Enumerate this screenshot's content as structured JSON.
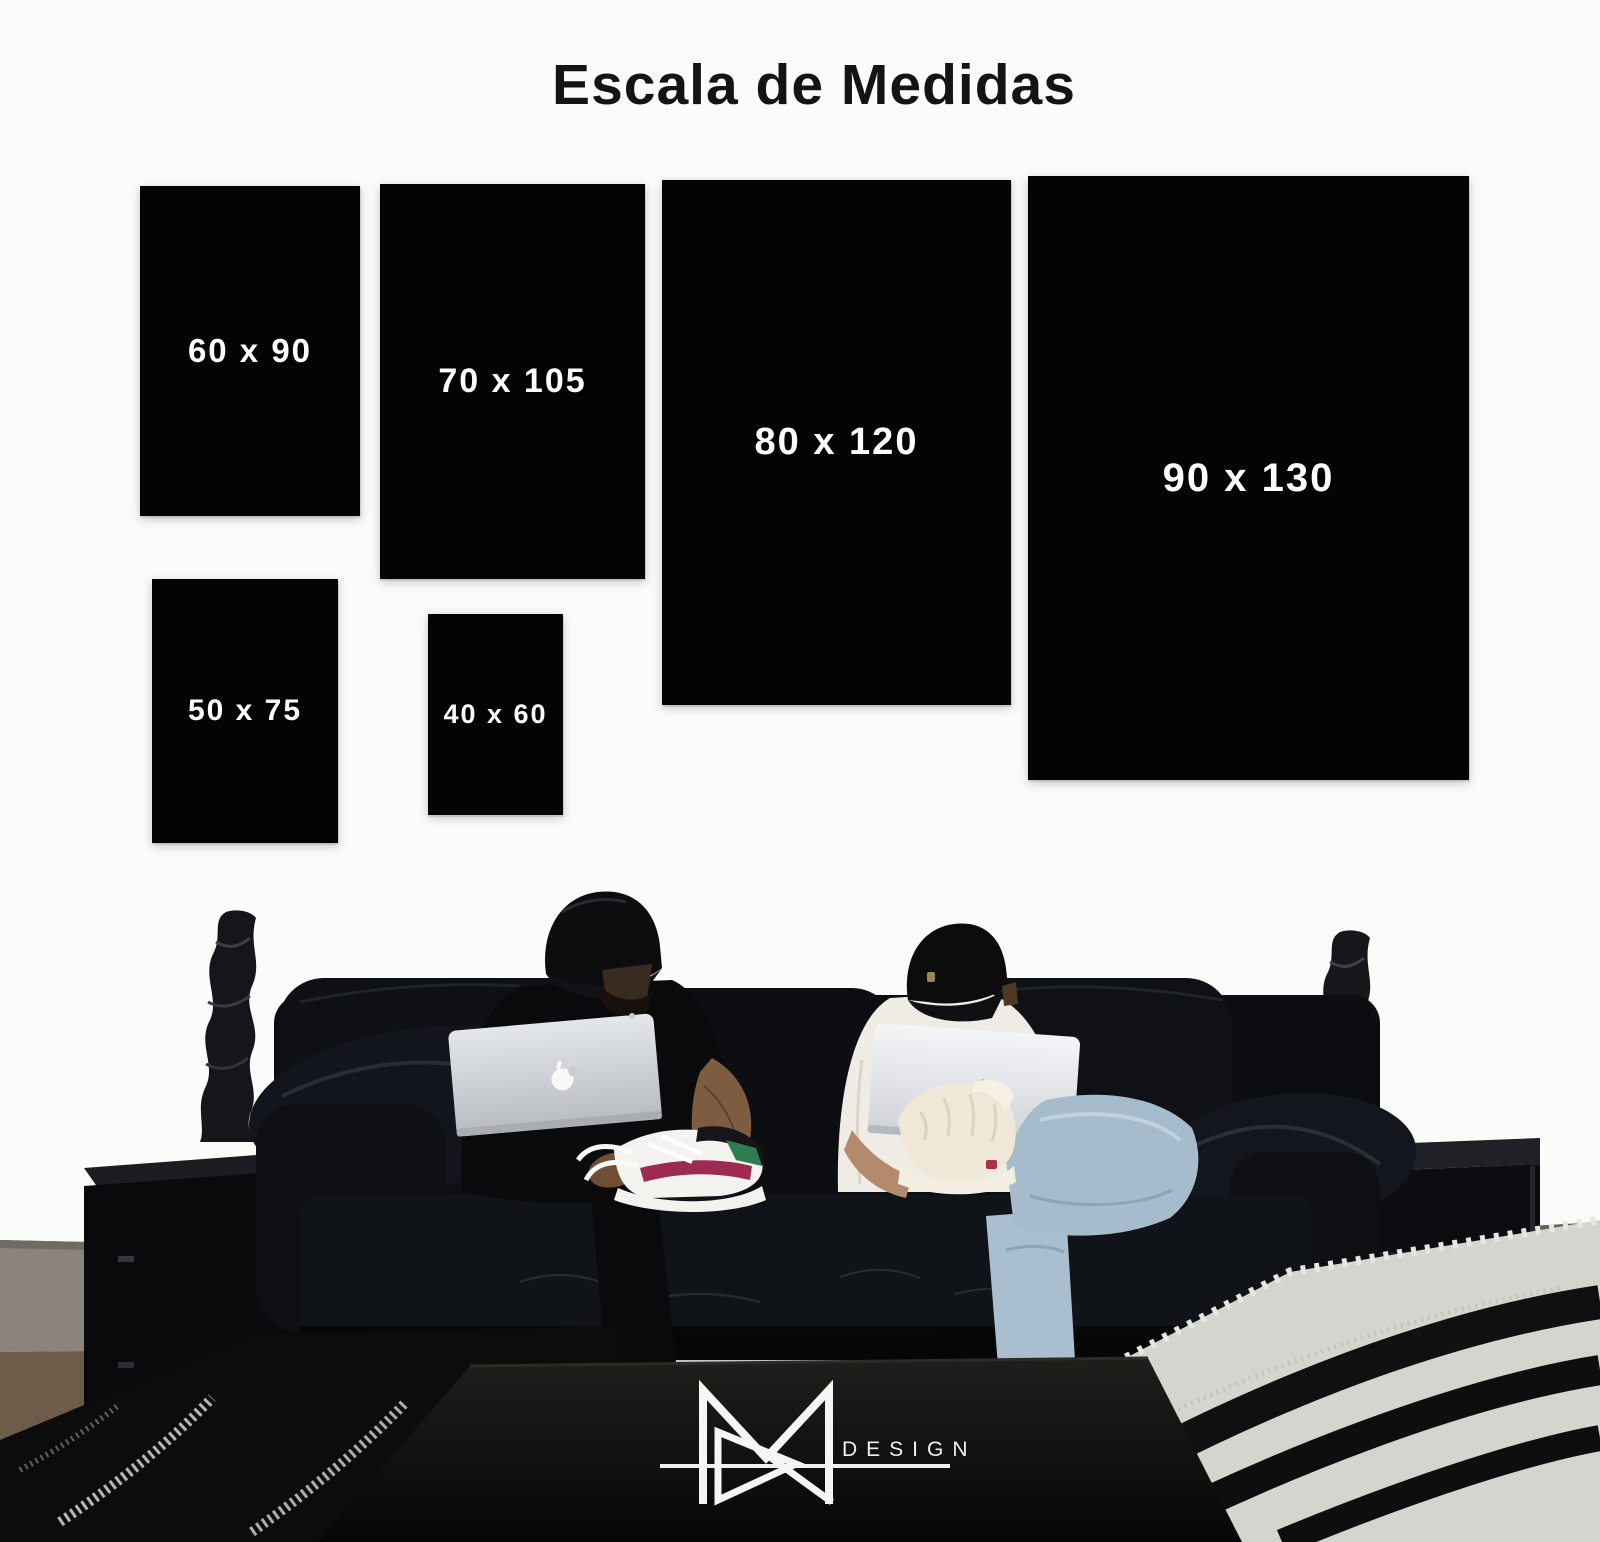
{
  "title": "Escala de Medidas",
  "sizes": [
    {
      "label": "60 x 90",
      "width_cm": 60,
      "height_cm": 90
    },
    {
      "label": "70 x 105",
      "width_cm": 70,
      "height_cm": 105
    },
    {
      "label": "80 x 120",
      "width_cm": 80,
      "height_cm": 120
    },
    {
      "label": "90 x 130",
      "width_cm": 90,
      "height_cm": 130
    },
    {
      "label": "50 x 75",
      "width_cm": 50,
      "height_cm": 75
    },
    {
      "label": "40 x 60",
      "width_cm": 40,
      "height_cm": 60
    }
  ],
  "brand": {
    "monogram": "MR",
    "wordmark": "DESIGN"
  },
  "colors": {
    "background": "#fbfbfa",
    "panel": "#040404",
    "panel_text": "#ffffff",
    "title_text": "#141414",
    "logo": "#f5f5f5",
    "sofa": "#0b0d10",
    "jeans": "#a6bccd"
  },
  "scene": {
    "description": "Two men in black caps sit on a black leather sofa using Apple MacBooks, between twisted black sculptures on black side tables; a black coffee table in front carries the MR DESIGN logo."
  }
}
